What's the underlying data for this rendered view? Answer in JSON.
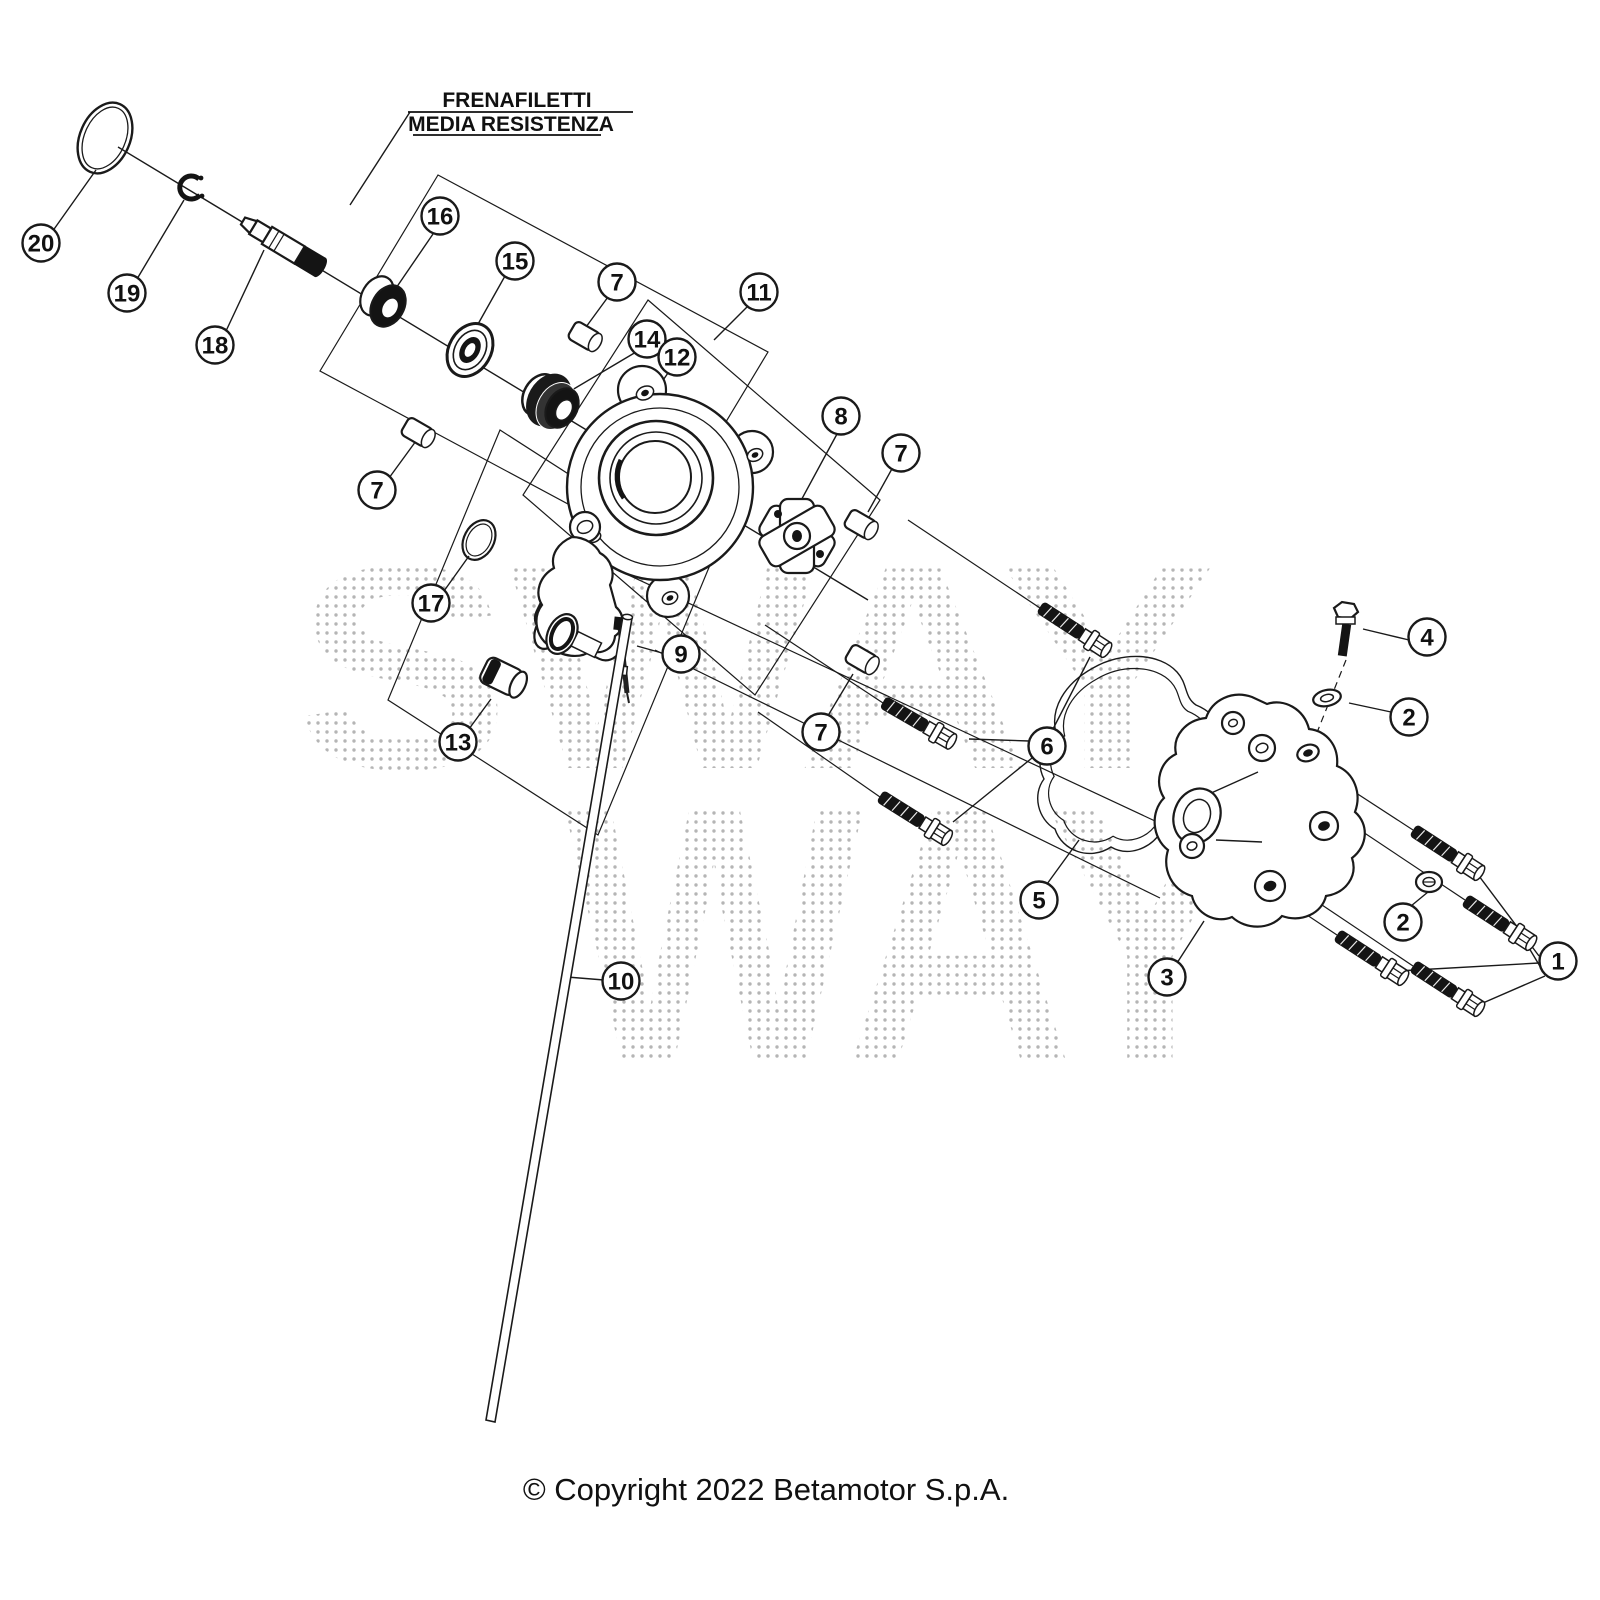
{
  "annotation_label": {
    "line1": "FRENAFILETTI",
    "line2": "MEDIA RESISTENZA"
  },
  "copyright_text": "© Copyright 2022 Betamotor S.p.A.",
  "watermark": {
    "line1": "SWAY",
    "line2": "WAY"
  },
  "diagram": {
    "ink_color": "#1a1a1a",
    "callout_radius": 18.5
  },
  "callouts": [
    {
      "id": "callout-20",
      "label": "20",
      "x": 41,
      "y": 243
    },
    {
      "id": "callout-19",
      "label": "19",
      "x": 127,
      "y": 293
    },
    {
      "id": "callout-18",
      "label": "18",
      "x": 215,
      "y": 345
    },
    {
      "id": "callout-16",
      "label": "16",
      "x": 440,
      "y": 216
    },
    {
      "id": "callout-15",
      "label": "15",
      "x": 515,
      "y": 261
    },
    {
      "id": "callout-7a",
      "label": "7",
      "x": 617,
      "y": 282
    },
    {
      "id": "callout-14",
      "label": "14",
      "x": 647,
      "y": 339
    },
    {
      "id": "callout-12",
      "label": "12",
      "x": 677,
      "y": 357
    },
    {
      "id": "callout-11",
      "label": "11",
      "x": 759,
      "y": 292
    },
    {
      "id": "callout-8",
      "label": "8",
      "x": 841,
      "y": 416
    },
    {
      "id": "callout-7b",
      "label": "7",
      "x": 901,
      "y": 453
    },
    {
      "id": "callout-7c",
      "label": "7",
      "x": 377,
      "y": 490
    },
    {
      "id": "callout-17",
      "label": "17",
      "x": 431,
      "y": 603
    },
    {
      "id": "callout-9",
      "label": "9",
      "x": 681,
      "y": 654
    },
    {
      "id": "callout-13",
      "label": "13",
      "x": 458,
      "y": 742
    },
    {
      "id": "callout-7d",
      "label": "7",
      "x": 821,
      "y": 732
    },
    {
      "id": "callout-6",
      "label": "6",
      "x": 1047,
      "y": 746
    },
    {
      "id": "callout-10",
      "label": "10",
      "x": 621,
      "y": 981
    },
    {
      "id": "callout-5",
      "label": "5",
      "x": 1039,
      "y": 900
    },
    {
      "id": "callout-3",
      "label": "3",
      "x": 1167,
      "y": 977
    },
    {
      "id": "callout-4",
      "label": "4",
      "x": 1427,
      "y": 637
    },
    {
      "id": "callout-2a",
      "label": "2",
      "x": 1409,
      "y": 717
    },
    {
      "id": "callout-2b",
      "label": "2",
      "x": 1403,
      "y": 922
    },
    {
      "id": "callout-1",
      "label": "1",
      "x": 1558,
      "y": 961
    }
  ]
}
